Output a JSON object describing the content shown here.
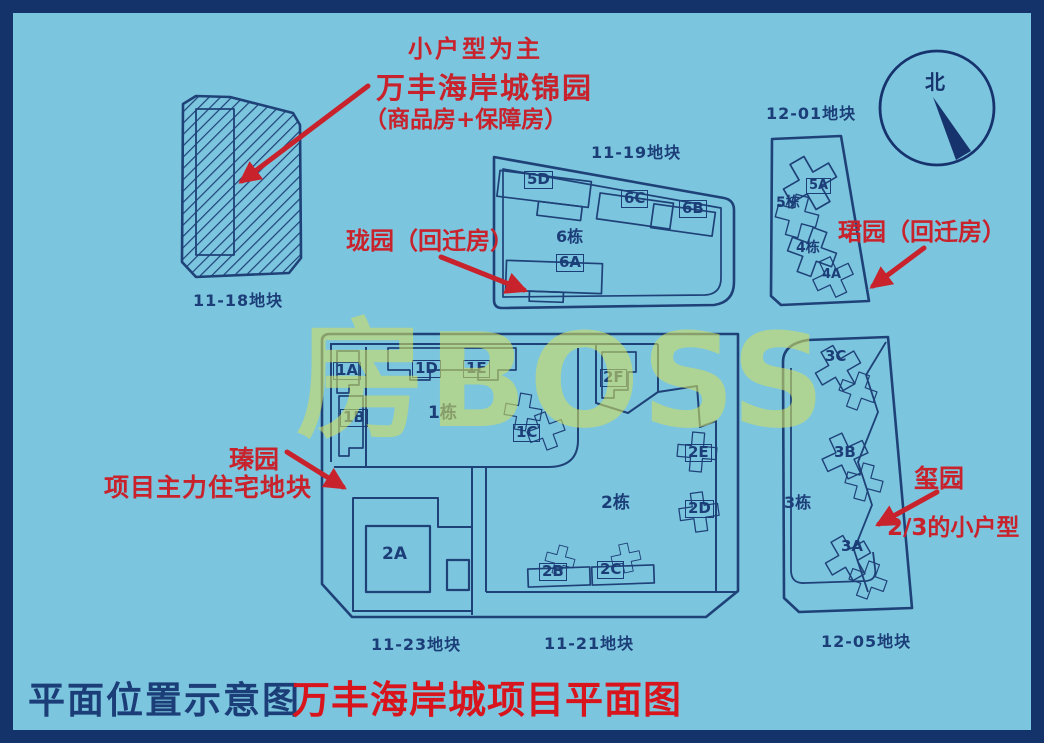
{
  "title_block": {
    "left": "平面位置示意图",
    "right": "万丰海岸城项目平面图"
  },
  "watermark": "房BOSS",
  "compass": {
    "north_label": "北"
  },
  "annotations": {
    "top_note": {
      "line1": "小户型为主",
      "line2": "万丰海岸城锦园",
      "line3": "（商品房+保障房）"
    },
    "longyuan": "珑园（回迁房）",
    "junyuan": "珺园（回迁房）",
    "zhenyuan": {
      "name": "瑧园",
      "desc": "项目主力住宅地块"
    },
    "xiyuan": {
      "name": "玺园",
      "desc": "2/3的小户型"
    }
  },
  "plot_labels": {
    "p1118": "11-18地块",
    "p1119": "11-19地块",
    "p1201": "12-01地块",
    "p1123": "11-23地块",
    "p1121": "11-21地块",
    "p1205": "12-05地块"
  },
  "buildings": {
    "b5D": "5D",
    "b6C": "6C",
    "b6B": "6B",
    "blk6": "6栋",
    "b6A": "6A",
    "b5A": "5A",
    "blk5": "5栋",
    "blk4": "4栋",
    "b4A": "4A",
    "b1A": "1A",
    "b1B": "1B",
    "b1C": "1C",
    "b1D": "1D",
    "b1E": "1E",
    "blk1": "1栋",
    "b2A": "2A",
    "b2B": "2B",
    "b2C": "2C",
    "b2D": "2D",
    "b2E": "2E",
    "b2F": "2F",
    "blk2": "2栋",
    "b3A": "3A",
    "b3B": "3B",
    "b3C": "3C",
    "blk3": "3栋"
  },
  "colors": {
    "background": "#7cc5de",
    "frame": "#14336b",
    "line_art": "#1e4178",
    "annotation_red": "#c8232c",
    "title_red": "#d8151d",
    "watermark_yellow": "#cede62"
  }
}
